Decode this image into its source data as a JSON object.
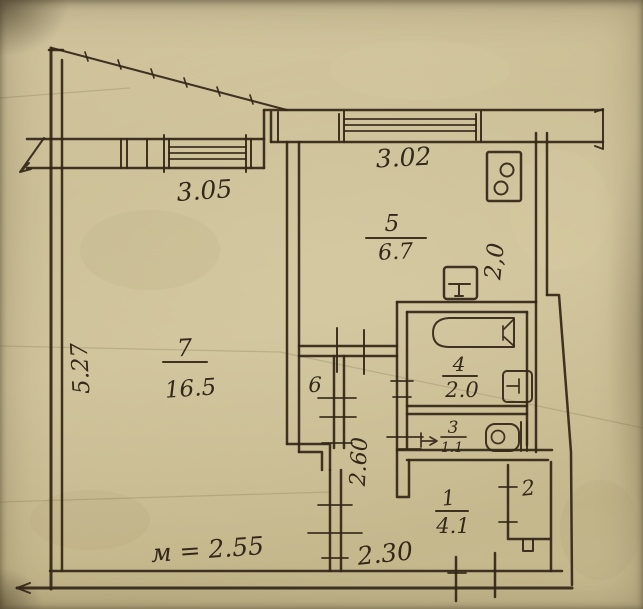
{
  "plan": {
    "type": "hand-drawn apartment floor plan (BTI sketch)",
    "rooms": {
      "living": {
        "number": "7",
        "area": "16.5"
      },
      "kitchen": {
        "number": "5",
        "area": "6.7"
      },
      "bath": {
        "number": "4",
        "area": "2.0"
      },
      "wc": {
        "number": "3",
        "area": "1.1"
      },
      "hall": {
        "number": "1",
        "area": "4.1"
      },
      "closet6": {
        "number": "6"
      },
      "closet2": {
        "number": "2"
      }
    },
    "dimensions": {
      "living_width": "3.05",
      "kitchen_width": "3.02",
      "living_depth": "5.27",
      "kitchen_depth": "2,0",
      "corridor_depth": "2.60",
      "hall_width": "2.30",
      "ceiling_height": "м = 2.55"
    },
    "colors": {
      "paper": "#c9bc92",
      "ink": "#342718"
    }
  }
}
